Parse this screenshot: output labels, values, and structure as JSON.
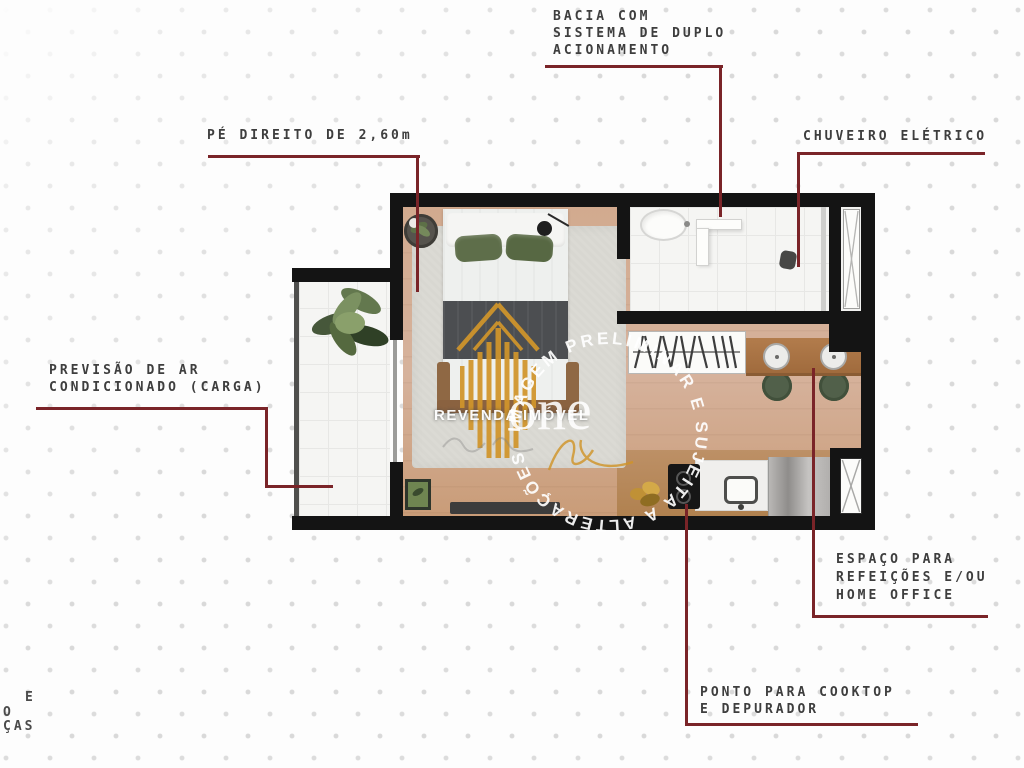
{
  "annotations": {
    "bacia": {
      "lines": [
        "BACIA COM",
        "SISTEMA DE DUPLO",
        "ACIONAMENTO"
      ]
    },
    "pe_direito": {
      "label": "PÉ DIREITO DE 2,60m"
    },
    "chuveiro": {
      "label": "CHUVEIRO ELÉTRICO"
    },
    "ar_condicionado": {
      "lines": [
        "PREVISÃO DE AR",
        "CONDICIONADO (CARGA)"
      ]
    },
    "refeicoes": {
      "lines": [
        "ESPAÇO PARA",
        "REFEIÇÕES E/OU",
        "HOME OFFICE"
      ]
    },
    "cooktop": {
      "lines": [
        "PONTO PARA COOKTOP",
        "E DEPURADOR"
      ]
    }
  },
  "watermark": {
    "brand": "REVENDA IMÓVEL",
    "logo_text": "one",
    "disclaimer_arc": "IMAGEM PRELIMINAR E SUJEITA A ALTERAÇÕES"
  },
  "edge_fragments": {
    "line1": "E",
    "line2": "O",
    "line3": "ÇAS"
  },
  "colors": {
    "callout_line": "#7a2428",
    "callout_text": "#3e3e3e",
    "wall": "#141414",
    "wood_floor": "#d0a88c",
    "logo_gold": "#d1952b"
  }
}
